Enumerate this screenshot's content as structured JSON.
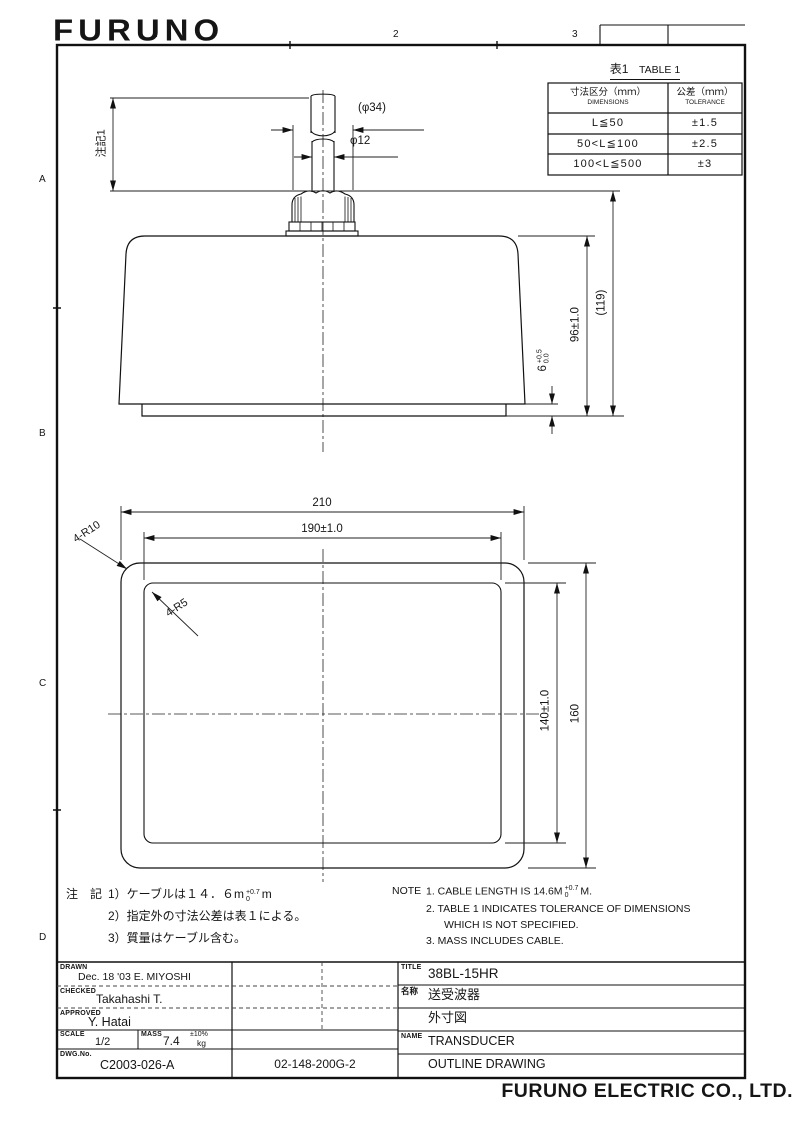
{
  "sheet": {
    "logo": "FURUNO",
    "footer": "FURUNO ELECTRIC CO., LTD.",
    "grid_cols": [
      "1",
      "2",
      "3"
    ],
    "grid_rows": [
      "A",
      "B",
      "C",
      "D"
    ]
  },
  "table1": {
    "title_jp": "表1",
    "title_en": "TABLE 1",
    "col_dim_jp": "寸法区分（ｍｍ）",
    "col_dim_en": "DIMENSIONS",
    "col_tol_jp": "公差（ｍｍ）",
    "col_tol_en": "TOLERANCE",
    "rows": [
      {
        "range": "L≦50",
        "tol": "±1.5"
      },
      {
        "range": "50<L≦100",
        "tol": "±2.5"
      },
      {
        "range": "100<L≦500",
        "tol": "±3"
      }
    ]
  },
  "side_view": {
    "note_ref": "注記1",
    "dia_cable_protector": "(φ34)",
    "dia_cable": "φ12",
    "height_body": "96±1.0",
    "height_overall": "(119)",
    "base_thickness": "6",
    "base_tol_upper": "+0.5",
    "base_tol_lower": "0.0"
  },
  "plan_view": {
    "width_overall": "210",
    "width_inner": "190±1.0",
    "height_overall": "160",
    "height_inner": "140±1.0",
    "radius_outer": "4-R10",
    "radius_inner": "4-R5"
  },
  "notes_jp": {
    "heading": "注　記",
    "line1_pre": "1）ケーブルは１４．６m",
    "line1_tol_upper": "+0.7",
    "line1_tol_lower": "0",
    "line1_post": "m",
    "line2": "2）指定外の寸法公差は表１による。",
    "line3": "3）質量はケーブル含む。"
  },
  "notes_en": {
    "heading": "NOTE",
    "line1_pre": "1.  CABLE LENGTH IS 14.6M",
    "line1_tol_upper": "+0.7",
    "line1_tol_lower": "0",
    "line1_post": "M.",
    "line2": "2.  TABLE 1 INDICATES TOLERANCE OF DIMENSIONS",
    "line2b": "WHICH IS NOT SPECIFIED.",
    "line3": "3.  MASS INCLUDES CABLE."
  },
  "title_block": {
    "drawn_label": "DRAWN",
    "drawn_value": "Dec. 18 '03  E. MIYOSHI",
    "checked_label": "CHECKED",
    "checked_value": "Takahashi T.",
    "approved_label": "APPROVED",
    "approved_value": "Y. Hatai",
    "scale_label": "SCALE",
    "scale_value": "1/2",
    "mass_label": "MASS",
    "mass_value": "7.4",
    "mass_tol": "±10%",
    "mass_unit": "kg",
    "dwg_no_label": "DWG.No.",
    "dwg_no_value": "C2003-026-A",
    "ref_no": "02-148-200G-2",
    "title_label": "TITLE",
    "title_value": "38BL-15HR",
    "name_jp_label": "名称",
    "name_jp_value": "送受波器",
    "drawing_type_jp": "外寸図",
    "name_en_label": "NAME",
    "name_en_value": "TRANSDUCER",
    "name_en_sub": "OUTLINE DRAWING"
  }
}
